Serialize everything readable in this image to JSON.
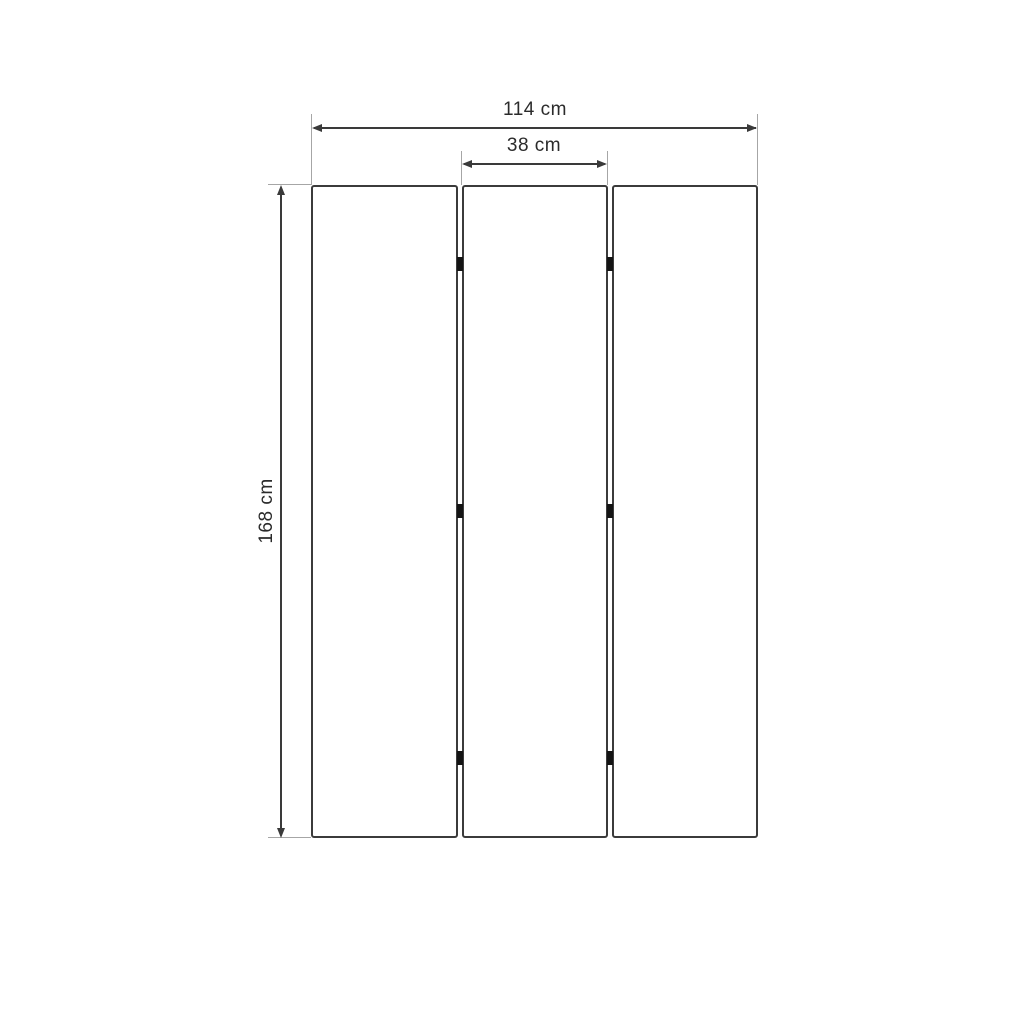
{
  "diagram": {
    "title": "Three-panel folding screen dimension drawing",
    "labels": {
      "total_width": "114 cm",
      "panel_width": "38 cm",
      "height": "168 cm"
    },
    "measurements": {
      "total_width_cm": 114,
      "panel_width_cm": 38,
      "height_cm": 168
    },
    "panels": {
      "count": 3,
      "hinges_per_gap": 3
    },
    "colors": {
      "background": "#ffffff",
      "panel_border": "#3b3b3b",
      "dimension_line": "#3a3a3a",
      "extension_line": "#a6a6a6",
      "hinge": "#141414",
      "text": "#2b2b2b"
    }
  }
}
